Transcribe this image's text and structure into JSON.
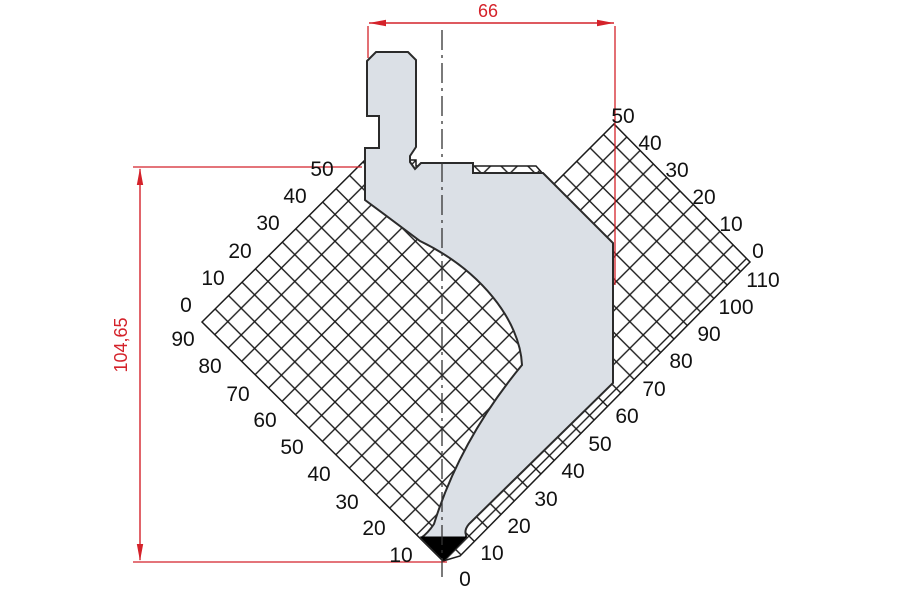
{
  "drawing_type": "press-brake-punch-technical-drawing",
  "colors": {
    "dimension_red": "#d4222a",
    "punch_fill": "#dbe0e6",
    "punch_outline": "#2b2b2b",
    "grid_line": "#1b1b1b",
    "tip_black": "#000000",
    "background": "#ffffff"
  },
  "dimensions": {
    "width_label": "66",
    "height_label": "104,65"
  },
  "grid": {
    "cell_mm": 5,
    "scales": {
      "upper_left": [
        {
          "v": "50",
          "x": 322,
          "y": 176
        },
        {
          "v": "40",
          "x": 295,
          "y": 203
        },
        {
          "v": "30",
          "x": 268,
          "y": 230
        },
        {
          "v": "20",
          "x": 240,
          "y": 258
        },
        {
          "v": "10",
          "x": 213,
          "y": 285
        },
        {
          "v": "0",
          "x": 186,
          "y": 312
        }
      ],
      "lower_left": [
        {
          "v": "90",
          "x": 183,
          "y": 346
        },
        {
          "v": "80",
          "x": 210,
          "y": 373
        },
        {
          "v": "70",
          "x": 238,
          "y": 401
        },
        {
          "v": "60",
          "x": 265,
          "y": 427
        },
        {
          "v": "50",
          "x": 292,
          "y": 454
        },
        {
          "v": "40",
          "x": 319,
          "y": 481
        },
        {
          "v": "30",
          "x": 347,
          "y": 509
        },
        {
          "v": "20",
          "x": 374,
          "y": 535
        },
        {
          "v": "10",
          "x": 401,
          "y": 562
        }
      ],
      "lower_right": [
        {
          "v": "0",
          "x": 465,
          "y": 586
        },
        {
          "v": "10",
          "x": 492,
          "y": 560
        },
        {
          "v": "20",
          "x": 519,
          "y": 533
        },
        {
          "v": "30",
          "x": 546,
          "y": 506
        },
        {
          "v": "40",
          "x": 573,
          "y": 478
        },
        {
          "v": "50",
          "x": 600,
          "y": 451
        },
        {
          "v": "60",
          "x": 627,
          "y": 423
        },
        {
          "v": "70",
          "x": 654,
          "y": 396
        },
        {
          "v": "80",
          "x": 681,
          "y": 368
        },
        {
          "v": "90",
          "x": 709,
          "y": 341
        },
        {
          "v": "100",
          "x": 736,
          "y": 314
        },
        {
          "v": "110",
          "x": 763,
          "y": 287
        }
      ],
      "upper_right": [
        {
          "v": "0",
          "x": 758,
          "y": 258
        },
        {
          "v": "10",
          "x": 731,
          "y": 231
        },
        {
          "v": "20",
          "x": 704,
          "y": 204
        },
        {
          "v": "30",
          "x": 677,
          "y": 177
        },
        {
          "v": "40",
          "x": 650,
          "y": 150
        },
        {
          "v": "50",
          "x": 623,
          "y": 123
        }
      ]
    }
  }
}
